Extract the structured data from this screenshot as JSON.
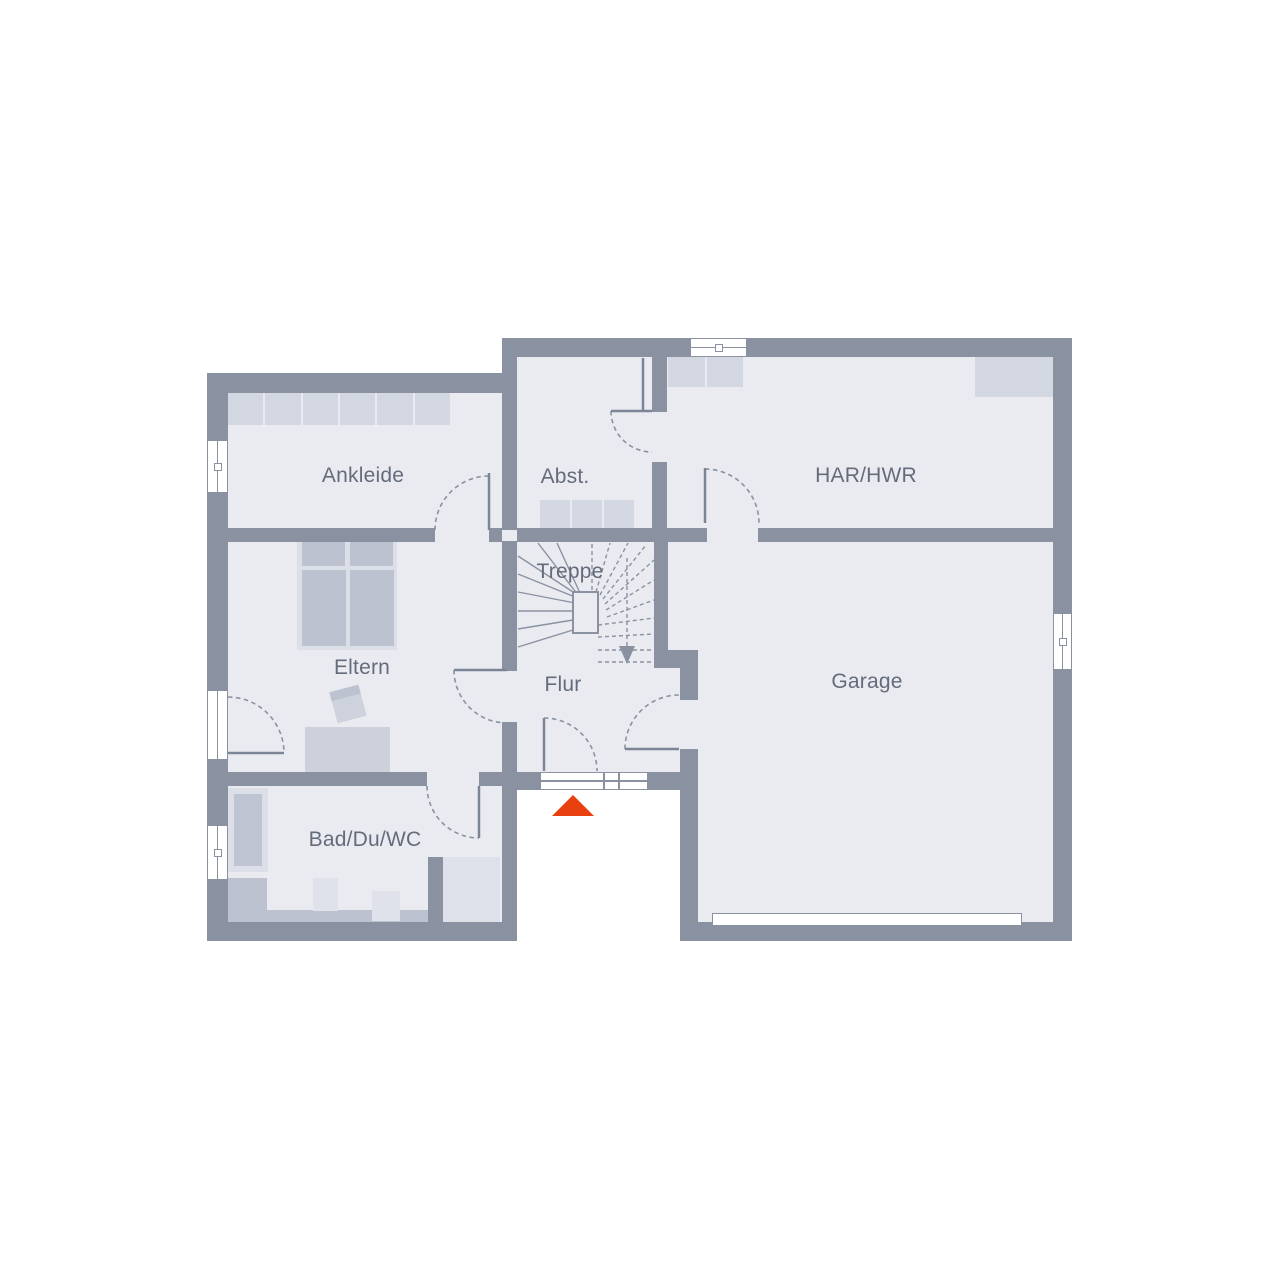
{
  "floorplan": {
    "rooms": [
      {
        "id": "ankleide",
        "label": "Ankleide"
      },
      {
        "id": "abstellraum",
        "label": "Abst."
      },
      {
        "id": "har-hwr",
        "label": "HAR/HWR"
      },
      {
        "id": "eltern",
        "label": "Eltern"
      },
      {
        "id": "treppe",
        "label": "Treppe"
      },
      {
        "id": "flur",
        "label": "Flur"
      },
      {
        "id": "garage",
        "label": "Garage"
      },
      {
        "id": "bad-du-wc",
        "label": "Bad/Du/WC"
      }
    ],
    "stairs": {
      "direction_arrow": "down"
    },
    "icons": {
      "entrance_marker": "red-triangle-up",
      "stair_arrow": "arrow-down"
    },
    "colors": {
      "wall": "#8a92a2",
      "floor": "#e9ebf1",
      "background": "#ffffff",
      "furniture_light": "#dcdfe7",
      "furniture_mid": "#d3d7e1",
      "furniture_dark": "#bcc2cf",
      "tub_inner": "#bfc5d2",
      "accent_red": "#e8400f",
      "label_text": "#646c7c"
    }
  }
}
